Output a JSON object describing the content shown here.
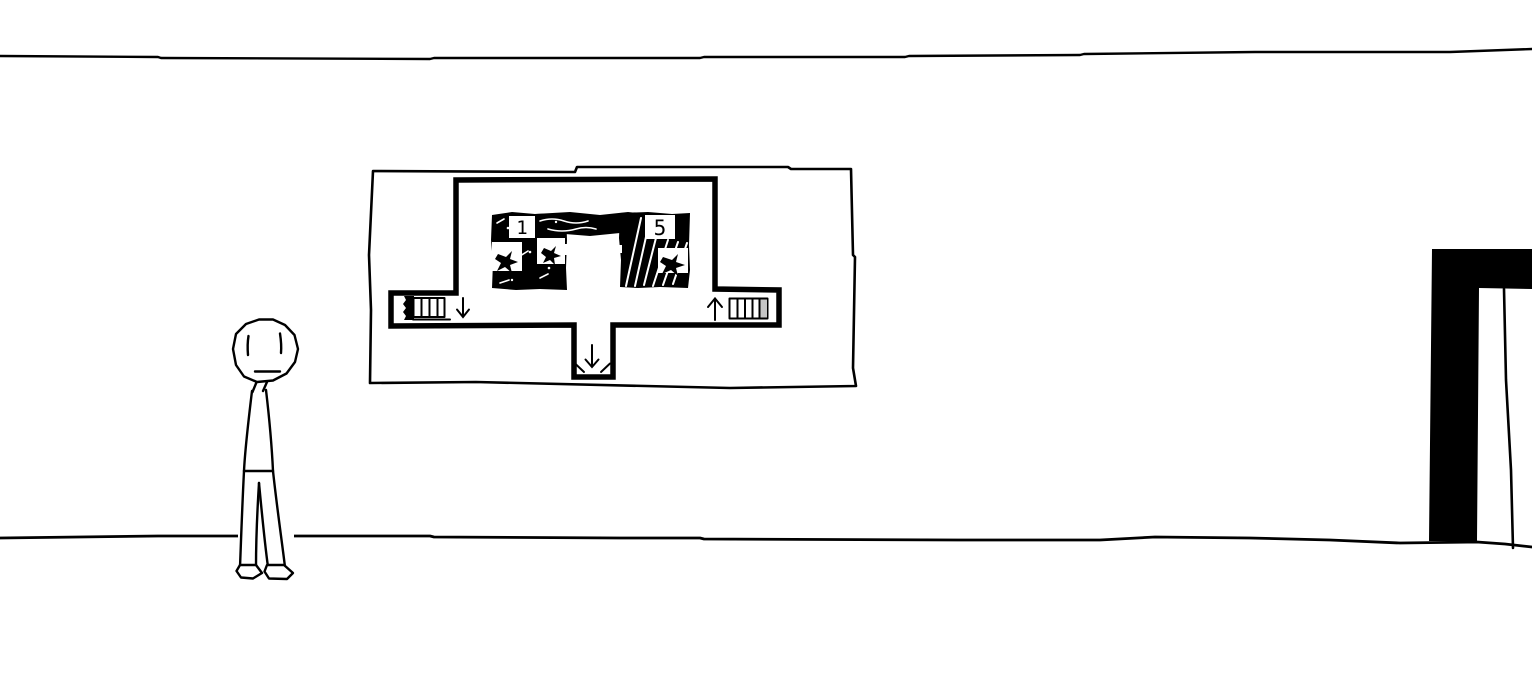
{
  "map_poster": {
    "rooms": [
      {
        "label": "1"
      },
      {
        "label": "5"
      }
    ],
    "icons": {
      "left_corridor_arrow": "down-arrow",
      "right_corridor_arrow": "up-arrow",
      "bottom_corridor_arrow": "down-arrow",
      "left_stairs": "stairs-ladder",
      "right_stairs": "stairs-ladder"
    }
  },
  "colors": {
    "ink": "#000000",
    "paper": "#ffffff",
    "stair_shade": "#c6c6c6"
  }
}
